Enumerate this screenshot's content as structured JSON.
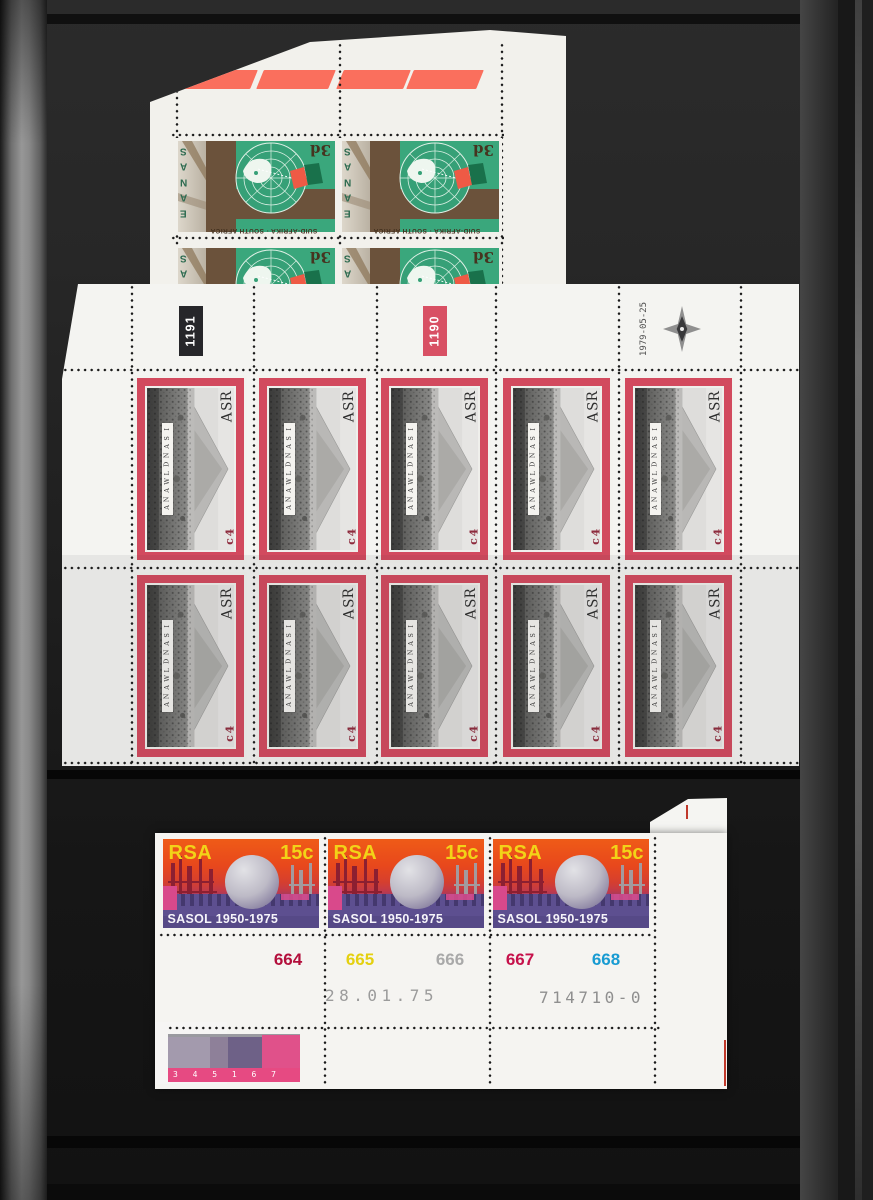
{
  "album": {
    "background_color": "#1e1e1e",
    "binding_strip_color": "#8c8c8c",
    "sheet_white": "#f4f4f1"
  },
  "sanae_sheet": {
    "marker_dash_color": "#fa6f5d",
    "grid": {
      "count": 4
    },
    "stamp": {
      "expedition_label": "SANAE",
      "denomination": "3d",
      "country_inscription": "SUID-AFRIKA · SOUTH AFRICA",
      "green": "#3aa77c",
      "brown": "#6b523b",
      "red_patch": "#ee5a45"
    }
  },
  "isandlwana_sheet": {
    "cylinder_number_black": "1191",
    "cylinder_number_red": "1190",
    "print_date": "1979-05-25",
    "corner_marker_icon": "four-point-star",
    "frame_color": "#d24a5e",
    "grid": {
      "count": 10
    },
    "stamp": {
      "country": "RSA",
      "title": "ISANDLWANA",
      "denomination": "4c"
    }
  },
  "sasol_sheet": {
    "count": 3,
    "stamp": {
      "country": "RSA",
      "denomination": "15c",
      "caption": "SASOL 1950-1975",
      "orange": "#e8481c",
      "purple": "#5d4f90",
      "yellow": "#f2d318"
    },
    "cylinder_numbers": [
      {
        "value": "664",
        "color": "#b30f3c"
      },
      {
        "value": "665",
        "color": "#e4d010"
      },
      {
        "value": "666",
        "color": "#a9a9a9"
      },
      {
        "value": "667",
        "color": "#c6114b"
      },
      {
        "value": "668",
        "color": "#189bd2"
      }
    ],
    "print_date": "28.01.75",
    "sheet_serial": "714710-0",
    "color_strip_digits": "3 4 5 1 6 7"
  }
}
